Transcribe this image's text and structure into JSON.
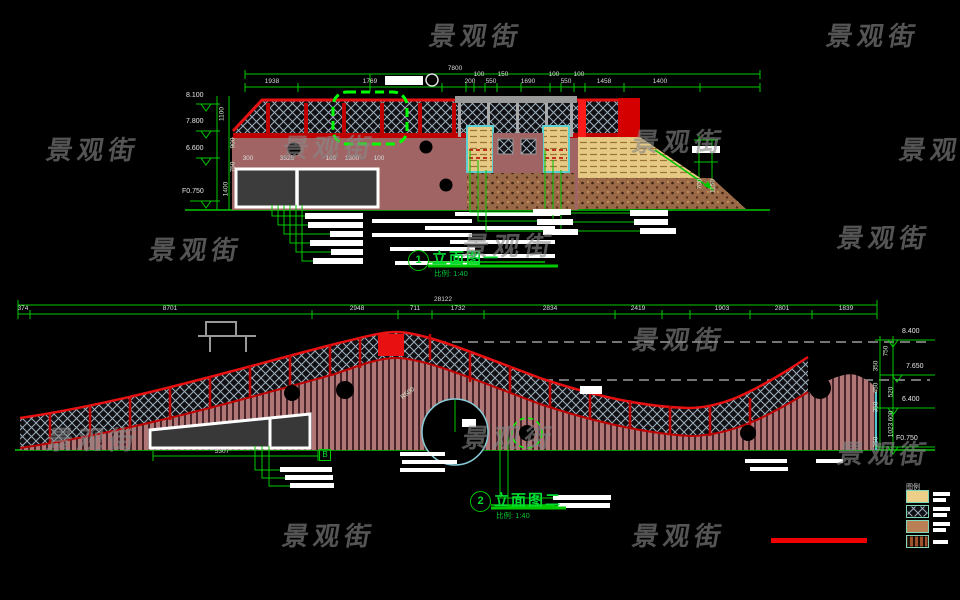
{
  "app": {
    "type": "cad-elevation-sheet",
    "background": "#000000"
  },
  "watermark": {
    "text": "景观街",
    "color": "#878787"
  },
  "drawing1": {
    "number": "1",
    "name": "立面图一",
    "scale": "比例: 1:40",
    "dim_total": "7800",
    "dims_top": [
      "1938",
      "1769",
      "200",
      "100",
      "550",
      "150",
      "1690",
      "100",
      "550",
      "100",
      "1458",
      "1400"
    ],
    "levels": [
      "8.100",
      "7.800",
      "6.600",
      "F0.750"
    ],
    "dims_left": [
      "1100",
      "900",
      "750",
      "1400"
    ],
    "dims_window": [
      "300",
      "3525",
      "100",
      "1300",
      "100"
    ],
    "dims_right": [
      "700",
      "1150"
    ]
  },
  "drawing2": {
    "number": "2",
    "name": "立面图二",
    "scale": "比例: 1:40",
    "dim_total": "28122",
    "dims_top": [
      "374",
      "8701",
      "2948",
      "711",
      "1732",
      "2834",
      "2419",
      "1903",
      "2801",
      "1839"
    ],
    "levels": [
      "8.400",
      "7.650",
      "6.400",
      "F0.750"
    ],
    "dims_right": [
      "750",
      "350",
      "450",
      "520",
      "350",
      "600",
      "1023",
      "350"
    ],
    "dim_bottom": "5307",
    "radius_label": "R500",
    "section_marker": "B"
  },
  "legend": {
    "title": "图例",
    "items": [
      {
        "swatch": "tan-solid-fill"
      },
      {
        "swatch": "dark-diamond-lattice"
      },
      {
        "swatch": "brown-speckle-soil"
      },
      {
        "swatch": "brown-vertical-stripes"
      }
    ]
  },
  "colors": {
    "background": "#000000",
    "dimension_green": "#00c800",
    "railing_red": "#e81010",
    "wall_rose": "#a06464",
    "planter_cyan": "#5ad0d0",
    "slope_tan": "#e5c985",
    "soil_brown": "#9a6a48",
    "callout_white": "#ffffff",
    "watermark_gray": "#828282",
    "legend_border": "#7fd8b8",
    "scale_bar_red": "#f00000"
  }
}
